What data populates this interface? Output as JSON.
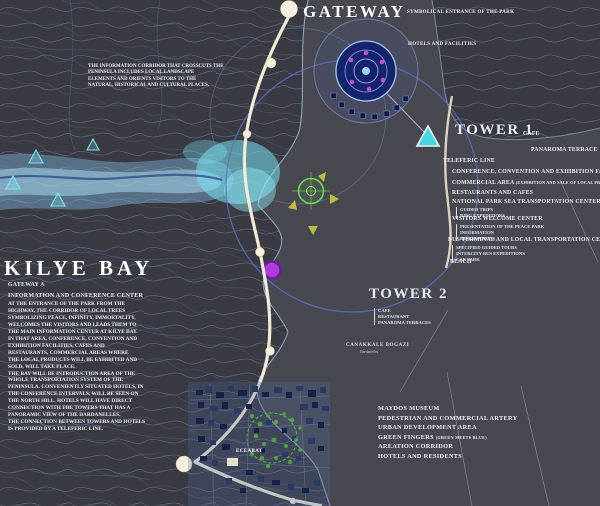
{
  "header": {
    "gateway_title": "GATEWAY",
    "gateway_note": "SYMBOLICAL ENTRANCE OF THE PARK",
    "hotels_label": "HOTELS AND FACILITIES"
  },
  "corridor_note": "THE INFORMATION CORRIDOR THAT CROSSCUTS THE\nPENINSULA INCLUDES LOCAL LANDSCAPE\nELEMENTS AND ORIENTS VISITORS TO THE\nNATURAL, HISTORICAL AND CULTURAL PLACES.",
  "tower1": {
    "title": "TOWER 1",
    "cafe": "CAFE",
    "terrace": "PANAROMA TERRACE",
    "teleferic": "TELEFERIC LINE",
    "conference": "CONFERENCE, CONVENTION AND EXHIBITION FACILITIES",
    "commercial": "COMMERCIAL AREA",
    "commercial_note": "(EXHIBITION AND SALE OF LOCAL PRODUCTS)",
    "restaurants": "RESTAURANTS AND CAFES",
    "sea_center": "NATIONAL PARK SEA TRANSPORTATION CENTER",
    "sea_center_items": [
      "GUIDED TRIPS",
      "RING EXPEDITIONS"
    ],
    "welcome": "VISITORS WELCOME CENTER",
    "welcome_items": [
      "PRESENTATION OF THE PEACE PARK",
      "INFORMATION",
      "RESERVATIONS"
    ],
    "bus": "BUS TERMINAL AND LOCAL TRANSPORTATION CENTER",
    "bus_items": [
      "SPECIFIED GUIDED TOURS",
      "INTERCITY BUS EXPEDITIONS",
      "CAR PARK"
    ],
    "beach": "BEACH"
  },
  "kilye": {
    "title": "KILYE BAY",
    "gateway": "GATEWAY A",
    "heading": "INFORMATION AND CONFERENCE CENTER",
    "body": "AT THE ENTRANCE OF THE PARK FROM THE\nHIGHWAY, THE CORRIDOR OF LOCAL TREES\nSYMBOLIZING PEACE, INFINITY, IMMORTALITY,\nWELCOMES THE VISITORS AND LEADS THEM TO\nTHE MAIN INFORMATION CENTER AT KILYE BAY.\nIN THAT AREA, CONFERENCE, CONVENTION AND\nEXHIBITION FACILITIES, CAFES AND\nRESTAURANTS, COMMERCIAL AREAS WHERE\nTHE LOCAL PRODUCTS WILL BE EXHIBITED AND\nSOLD, WILL TAKE PLACE.\nTHE BAY WILL BE INTRODUCTION AREA OF THE\nWHOLE TRANSPORTATION SYSTEM OF THE\nPENINSULA. CONVENIENTLY SITUATED HOTELS, IN\nTHE CONFERENCE INTERVALS, WILL BE SEEN ON\nTHE NORTH HILL. HOTELS WILL HAVE DIRECT\nCONNECTION WITH THE TOWERS THAT HAS A\nPANORAMIC VIEW OF THE DARDANELLES.\nTHE CONNECTION BETWEEN TOWERS AND HOTELS\nIS PROVIDED BY A TELEFERIC LINE."
  },
  "tower2": {
    "title": "TOWER 2",
    "items": [
      "CAFE",
      "RESTAURANT",
      "PANAROMA TERRACES"
    ]
  },
  "strait": {
    "name": "CANAKKALE BOGAZI",
    "subname": "Dardanelles"
  },
  "south_list": {
    "items": [
      "MAYDOS MUSEUM",
      "PEDESTRIAN AND COMMERCIAL ARTERY",
      "URBAN DEVELOPMENT AREA",
      "GREEN FINGERS",
      "AREATION CORRIDOR",
      "HOTELS AND RESIDENTS"
    ],
    "green_note": "(GREEN MEETS BLUE)"
  },
  "town": {
    "name": "ECEABAT"
  },
  "colors": {
    "bay_cyan": "#79E2F2",
    "road_cream": "#F2ECD6",
    "ring_blue": "#5F6FC4",
    "tower_marker_cyan": "#43DFE8",
    "node_purple": "#AB3FD8",
    "target_green": "#6FD84C",
    "town_green": "#4FB63C",
    "land_gray": "#393A42",
    "sea_gray": "#474850"
  }
}
